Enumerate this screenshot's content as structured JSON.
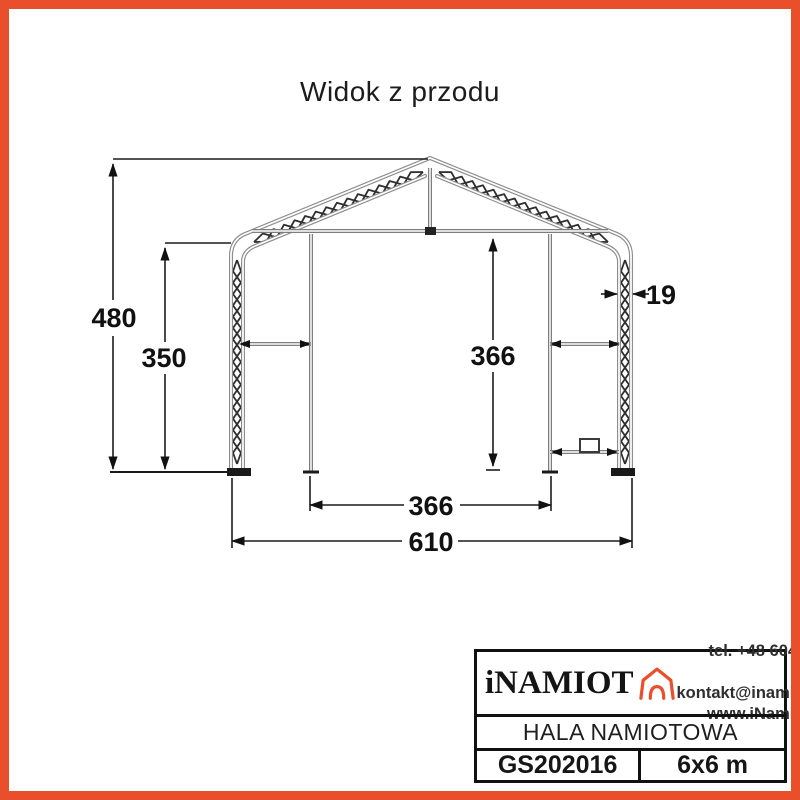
{
  "page": {
    "title": "Widok z przodu"
  },
  "drawing": {
    "description": "tent-hall-front-view-technical-drawing",
    "dimensions": {
      "overall_height": "480",
      "side_wall_height": "350",
      "clear_inner_height": "366",
      "truss_thickness": "19",
      "door_width": "366",
      "overall_width": "610"
    }
  },
  "title_block": {
    "brand": "iNAMIOT",
    "logo_icon": "tent-house-icon",
    "contact": {
      "phone": "tel. +48 604 108 143",
      "email": "kontakt@inamiot.pl",
      "website": "www.iNamiot.pl"
    },
    "product_name": "HALA NAMIOTOWA",
    "model": "GS202016",
    "size": "6x6 m"
  },
  "colors": {
    "accent": "#E94F2A",
    "structure_gray": "#8d8d8d",
    "ink": "#111111"
  }
}
